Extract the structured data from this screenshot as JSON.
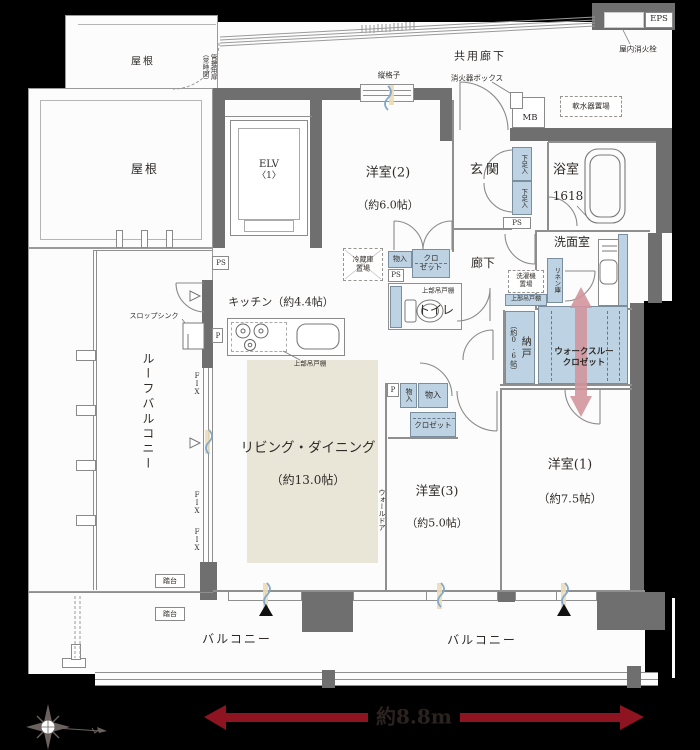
{
  "rooms": {
    "living_dining": {
      "label": "リビング・ダイニング",
      "size": "（約13.0帖）"
    },
    "kitchen": {
      "label": "キッチン（約4.4帖）"
    },
    "western1": {
      "label": "洋室(1)",
      "size": "（約7.5帖）"
    },
    "western2": {
      "label": "洋室(2)",
      "size": "（約6.0帖）"
    },
    "western3": {
      "label": "洋室(3)",
      "size": "（約5.0帖）"
    },
    "entrance": {
      "label": "玄関"
    },
    "bathroom": {
      "label": "浴室",
      "size": "1618"
    },
    "washroom": {
      "label": "洗面室"
    },
    "toilet": {
      "label": "トイレ"
    },
    "hallway": {
      "label": "廊下"
    },
    "storage_room": {
      "label": "納戸",
      "size": "（約0.6帖）"
    },
    "walk_through_closet": {
      "line1": "ウォークスルー",
      "line2": "クロゼット"
    },
    "common_corridor": {
      "label": "共用廊下"
    },
    "roof_balcony": {
      "label": "ルーフバルコニー"
    },
    "balcony": {
      "label": "バルコニー"
    },
    "roof": {
      "label": "屋根"
    },
    "elevator": {
      "line1": "ELV",
      "line2": "〈1〉"
    }
  },
  "fixtures": {
    "eps": "EPS",
    "indoor_hydrant": "屋内消火栓",
    "extinguisher_box": "消火器ボックス",
    "meter_box": "MB",
    "water_softener": "軟水器置場",
    "vertical_lattice": "縦格子",
    "mgmt_door": "管理用扉",
    "mgmt_door_note": "（常時閉）",
    "shoe_cupboard": "下足入",
    "pipe_space": "PS",
    "pipe": "P",
    "fix_window": "FIX",
    "fridge_line1": "冷蔵庫",
    "fridge_line2": "置場",
    "storage_small": "物入",
    "closet_line1": "クロ",
    "closet_line2": "ゼット",
    "closet": "クロゼット",
    "upper_cabinet": "上部吊戸棚",
    "washer_line1": "洗濯機",
    "washer_line2": "置場",
    "linen_cabinet": "リネン庫",
    "slop_sink": "スロップシンク",
    "wall_door": "ウォールドア",
    "step_stand": "踏台"
  },
  "annotations": {
    "width_dimension": "約8.8m"
  },
  "colors": {
    "background": "#000000",
    "wall": "#6f6f6f",
    "storage_fill": "#bdd2e2",
    "ld_floor": "#e9e6d8",
    "arrow_pink": "#d2949c",
    "dimension_red": "#8d1420"
  }
}
